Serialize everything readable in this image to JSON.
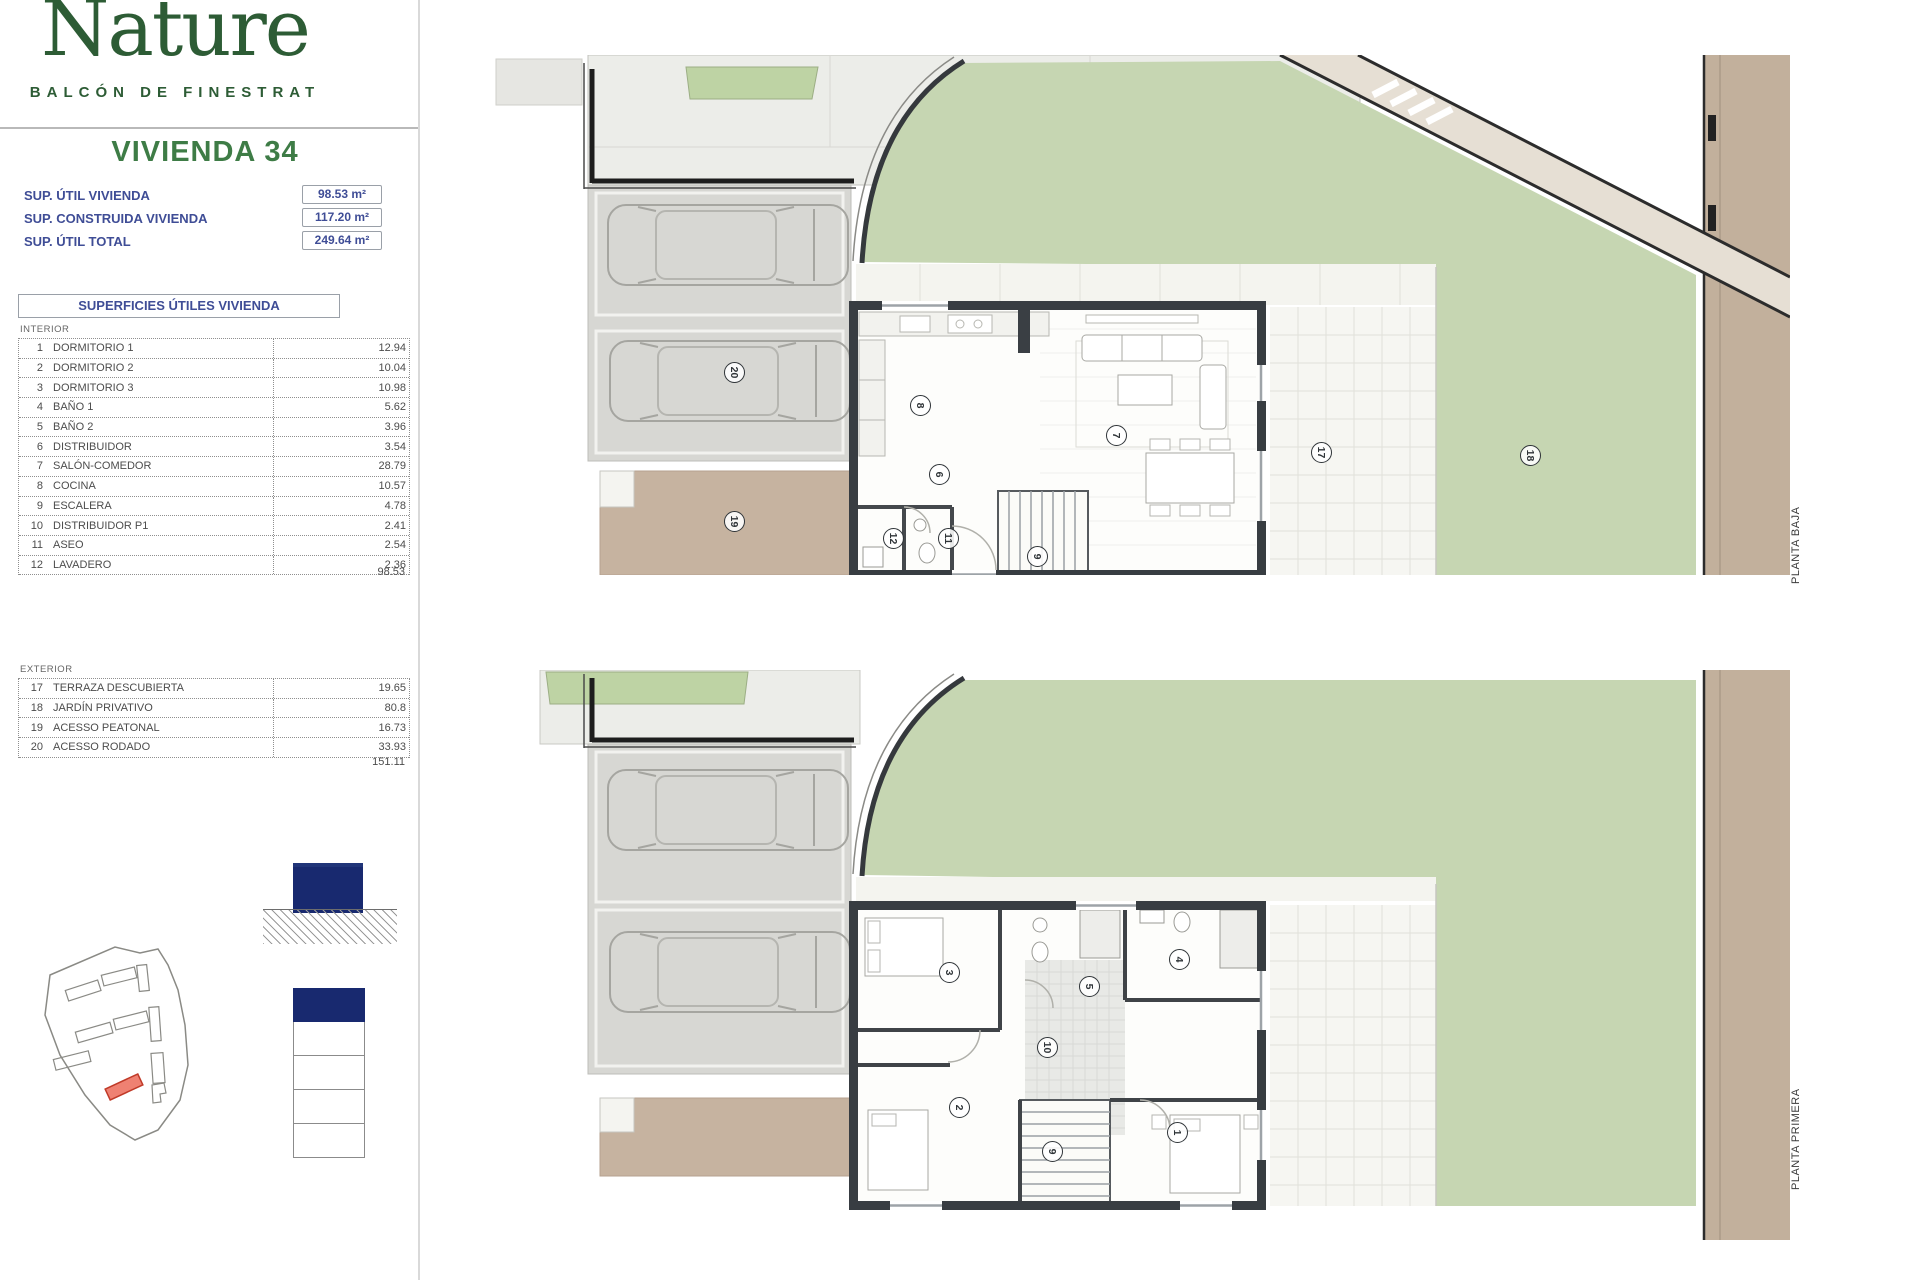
{
  "brand": {
    "name": "Nature",
    "tagline": "BALCÓN DE FINESTRAT"
  },
  "unit_title": "VIVIENDA 34",
  "specs": [
    {
      "label": "SUP. ÚTIL VIVIENDA",
      "value": "98.53 m²"
    },
    {
      "label": "SUP. CONSTRUIDA VIVIENDA",
      "value": "117.20 m²"
    },
    {
      "label": "SUP. ÚTIL TOTAL",
      "value": "249.64 m²"
    }
  ],
  "areas_table": {
    "header": "SUPERFICIES ÚTILES VIVIENDA",
    "interior": {
      "section_label": "INTERIOR",
      "rows": [
        {
          "num": "1",
          "name": "DORMITORIO 1",
          "value": "12.94"
        },
        {
          "num": "2",
          "name": "DORMITORIO 2",
          "value": "10.04"
        },
        {
          "num": "3",
          "name": "DORMITORIO 3",
          "value": "10.98"
        },
        {
          "num": "4",
          "name": "BAÑO 1",
          "value": "5.62"
        },
        {
          "num": "5",
          "name": "BAÑO 2",
          "value": "3.96"
        },
        {
          "num": "6",
          "name": "DISTRIBUIDOR",
          "value": "3.54"
        },
        {
          "num": "7",
          "name": "SALÓN-COMEDOR",
          "value": "28.79"
        },
        {
          "num": "8",
          "name": "COCINA",
          "value": "10.57"
        },
        {
          "num": "9",
          "name": "ESCALERA",
          "value": "4.78"
        },
        {
          "num": "10",
          "name": "DISTRIBUIDOR P1",
          "value": "2.41"
        },
        {
          "num": "11",
          "name": "ASEO",
          "value": "2.54"
        },
        {
          "num": "12",
          "name": "LAVADERO",
          "value": "2.36"
        }
      ],
      "total": "98.53"
    },
    "exterior": {
      "section_label": "EXTERIOR",
      "rows": [
        {
          "num": "17",
          "name": "TERRAZA DESCUBIERTA",
          "value": "19.65"
        },
        {
          "num": "18",
          "name": "JARDÍN PRIVATIVO",
          "value": "80.8"
        },
        {
          "num": "19",
          "name": "ACESSO PEATONAL",
          "value": "16.73"
        },
        {
          "num": "20",
          "name": "ACESSO RODADO",
          "value": "33.93"
        }
      ],
      "total": "151.11"
    }
  },
  "plans": {
    "baja": {
      "label": "PLANTA BAJA",
      "bubbles": [
        "20",
        "19",
        "8",
        "6",
        "12",
        "11",
        "9",
        "7",
        "17",
        "18"
      ]
    },
    "primera": {
      "label": "PLANTA PRIMERA",
      "bubbles": [
        "3",
        "5",
        "4",
        "10",
        "2",
        "9",
        "1"
      ]
    }
  },
  "colors": {
    "brand_green": "#2d5c35",
    "title_green": "#3e7c46",
    "navy_text": "#3f4d96",
    "diagram_navy": "#18296f",
    "highlight_red": "#ef8172",
    "lawn_green": "#c6d6b2",
    "tan": "#c2b09c"
  }
}
